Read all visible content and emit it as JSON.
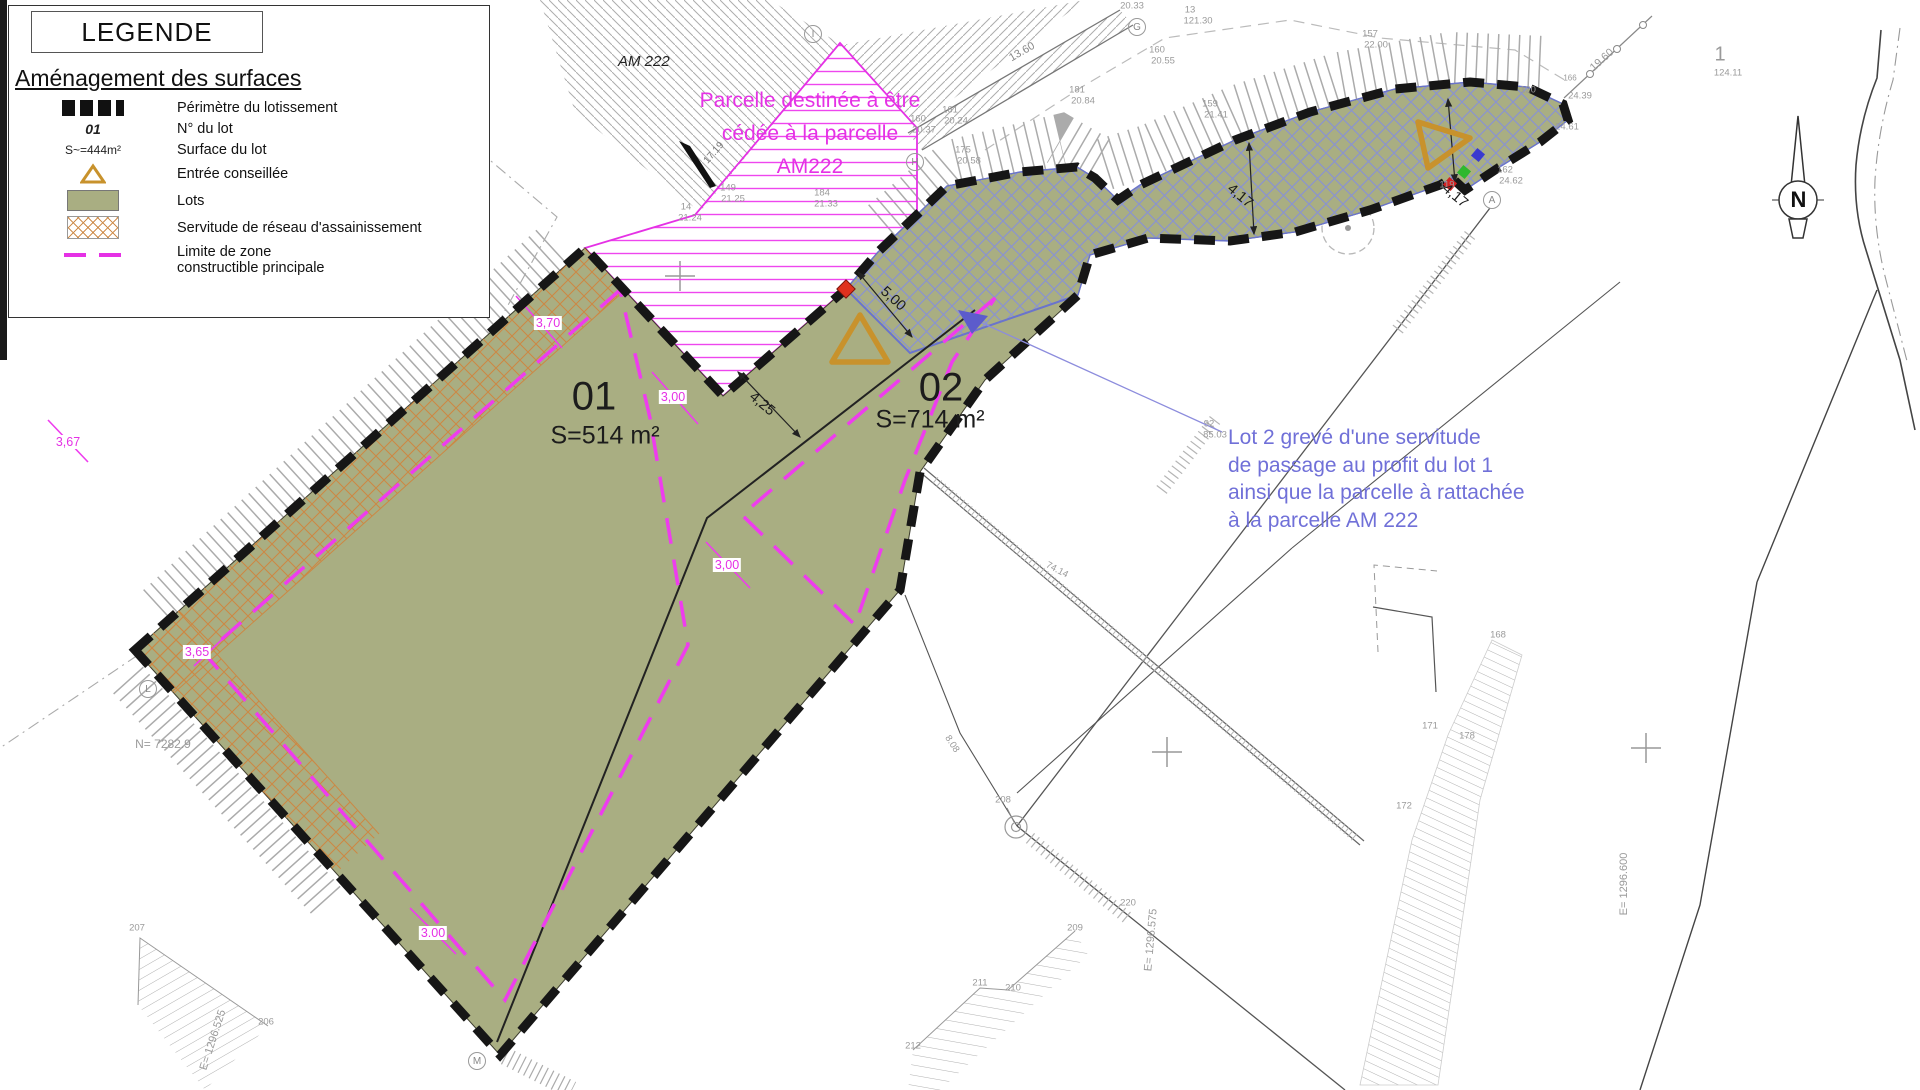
{
  "legend": {
    "title": "LEGENDE",
    "section": "Aménagement des surfaces",
    "items": [
      {
        "symbol": "perimeter-dashes",
        "label": "Périmètre du lotissement"
      },
      {
        "symbol": "lot-number",
        "symbol_text": "01",
        "label": "N° du lot"
      },
      {
        "symbol": "lot-surface",
        "symbol_text": "S~=444m²",
        "label": "Surface du lot"
      },
      {
        "symbol": "entrance-triangle",
        "label": "Entrée conseillée"
      },
      {
        "symbol": "lot-fill",
        "label": "Lots"
      },
      {
        "symbol": "sewer-crosshatch",
        "label": "Servitude de réseau d'assainissement"
      },
      {
        "symbol": "magenta-dash",
        "label_line1": "Limite de zone",
        "label_line2": "constructible principale"
      }
    ]
  },
  "lots": {
    "lot1": {
      "number": "01",
      "surface": "S=514 m²"
    },
    "lot2": {
      "number": "02",
      "surface": "S=714 m²"
    }
  },
  "notes": {
    "am222_label": "AM 222",
    "cession_lines": [
      "Parcelle destinée à être",
      "cédée à la parcelle",
      "AM222"
    ],
    "servitude_lines": [
      "Lot 2 grevé d'une servitude",
      "de passage au profit du lot 1",
      "ainsi que la parcelle à rattachée",
      "à la parcelle AM 222"
    ]
  },
  "compass_letter": "N",
  "point_markers": [
    {
      "letter": "I",
      "x": 813,
      "y": 34
    },
    {
      "letter": "G",
      "x": 1137,
      "y": 27
    },
    {
      "letter": "H",
      "x": 915,
      "y": 162
    },
    {
      "letter": "A",
      "x": 1492,
      "y": 200
    },
    {
      "letter": "L",
      "x": 148,
      "y": 689
    },
    {
      "letter": "M",
      "x": 477,
      "y": 1061
    }
  ],
  "dimension_labels": [
    {
      "t": "5,00",
      "x": 893,
      "y": 299,
      "r": 42
    },
    {
      "t": "4,25",
      "x": 762,
      "y": 404,
      "r": 40
    },
    {
      "t": "4,17",
      "x": 1240,
      "y": 196,
      "r": 40
    },
    {
      "t": "4,17",
      "x": 1455,
      "y": 196,
      "r": 40
    }
  ],
  "offset_labels": [
    {
      "t": "3,70",
      "x": 548,
      "y": 323
    },
    {
      "t": "3,67",
      "x": 68,
      "y": 442
    },
    {
      "t": "3,65",
      "x": 197,
      "y": 652
    },
    {
      "t": "3,00",
      "x": 673,
      "y": 397
    },
    {
      "t": "3,00",
      "x": 727,
      "y": 565
    },
    {
      "t": "3.00",
      "x": 433,
      "y": 933
    }
  ],
  "small_labels": [
    {
      "t": "20.33",
      "x": 1132,
      "y": 6
    },
    {
      "t": "13",
      "x": 1190,
      "y": 10
    },
    {
      "t": "121.30",
      "x": 1198,
      "y": 21
    },
    {
      "t": "160",
      "x": 1157,
      "y": 50
    },
    {
      "t": "20.55",
      "x": 1163,
      "y": 61
    },
    {
      "t": "181",
      "x": 1077,
      "y": 90
    },
    {
      "t": "20.84",
      "x": 1083,
      "y": 101
    },
    {
      "t": "175",
      "x": 963,
      "y": 150
    },
    {
      "t": "20.58",
      "x": 969,
      "y": 161
    },
    {
      "t": "160",
      "x": 918,
      "y": 119
    },
    {
      "t": "20.37",
      "x": 924,
      "y": 130
    },
    {
      "t": "161",
      "x": 950,
      "y": 110
    },
    {
      "t": "20.24",
      "x": 956,
      "y": 121
    },
    {
      "t": "159",
      "x": 1210,
      "y": 104
    },
    {
      "t": "21.41",
      "x": 1216,
      "y": 115
    },
    {
      "t": "157",
      "x": 1370,
      "y": 34
    },
    {
      "t": "22.00",
      "x": 1376,
      "y": 45
    },
    {
      "t": "120",
      "x": 1528,
      "y": 90
    },
    {
      "t": "24.61",
      "x": 1567,
      "y": 127
    },
    {
      "t": "119",
      "x": 1447,
      "y": 185
    },
    {
      "t": "162",
      "x": 1505,
      "y": 170
    },
    {
      "t": "24.62",
      "x": 1511,
      "y": 181
    },
    {
      "t": "149",
      "x": 728,
      "y": 188
    },
    {
      "t": "21.25",
      "x": 733,
      "y": 199
    },
    {
      "t": "184",
      "x": 822,
      "y": 193
    },
    {
      "t": "21.33",
      "x": 826,
      "y": 204
    },
    {
      "t": "14",
      "x": 686,
      "y": 207
    },
    {
      "t": "21.24",
      "x": 690,
      "y": 218
    },
    {
      "t": "74.14",
      "x": 1057,
      "y": 570,
      "r": 28
    },
    {
      "t": "8.08",
      "x": 952,
      "y": 744,
      "r": 57
    },
    {
      "t": "220",
      "x": 1128,
      "y": 903
    },
    {
      "t": "208",
      "x": 1003,
      "y": 800
    },
    {
      "t": "209",
      "x": 1075,
      "y": 928
    },
    {
      "t": "211",
      "x": 980,
      "y": 983
    },
    {
      "t": "210",
      "x": 1013,
      "y": 988
    },
    {
      "t": "212",
      "x": 913,
      "y": 1046
    },
    {
      "t": "207",
      "x": 137,
      "y": 928
    },
    {
      "t": "206",
      "x": 266,
      "y": 1022
    },
    {
      "t": "168",
      "x": 1498,
      "y": 635
    },
    {
      "t": "171",
      "x": 1430,
      "y": 726
    },
    {
      "t": "178",
      "x": 1467,
      "y": 736
    },
    {
      "t": "172",
      "x": 1404,
      "y": 806
    },
    {
      "t": "92",
      "x": 1209,
      "y": 424
    },
    {
      "t": "85.03",
      "x": 1215,
      "y": 435
    },
    {
      "t": "17.19",
      "x": 714,
      "y": 153,
      "r": -49,
      "fs": 10,
      "c": "#777777"
    },
    {
      "t": "19.60",
      "x": 1602,
      "y": 60,
      "r": -42,
      "fs": 11
    },
    {
      "t": "24.39",
      "x": 1580,
      "y": 96
    },
    {
      "t": "166",
      "x": 1570,
      "y": 78,
      "fs": 8
    },
    {
      "t": "13.60",
      "x": 1022,
      "y": 52,
      "r": -30,
      "fs": 11,
      "c": "#888888"
    },
    {
      "t": "1",
      "x": 1720,
      "y": 55,
      "fs": 20
    },
    {
      "t": "124.11",
      "x": 1728,
      "y": 73
    },
    {
      "t": "N= 7282.9",
      "x": 163,
      "y": 744,
      "fs": 12
    },
    {
      "t": "E= 1296.525",
      "x": 213,
      "y": 1040,
      "r": -72,
      "fs": 11
    },
    {
      "t": "E= 1296.575",
      "x": 1151,
      "y": 940,
      "r": -85,
      "fs": 11
    },
    {
      "t": "E= 1296.600",
      "x": 1624,
      "y": 884,
      "r": -90,
      "fs": 11
    }
  ],
  "colors": {
    "lot_green": "#a9ae82",
    "magenta": "#e531e5",
    "servitude_orange": "#cc8844",
    "entrance_orange": "#c8922c",
    "servitude_blue": "#8a93cf",
    "note_blue": "#7070d8",
    "perimeter_black": "#161616"
  }
}
